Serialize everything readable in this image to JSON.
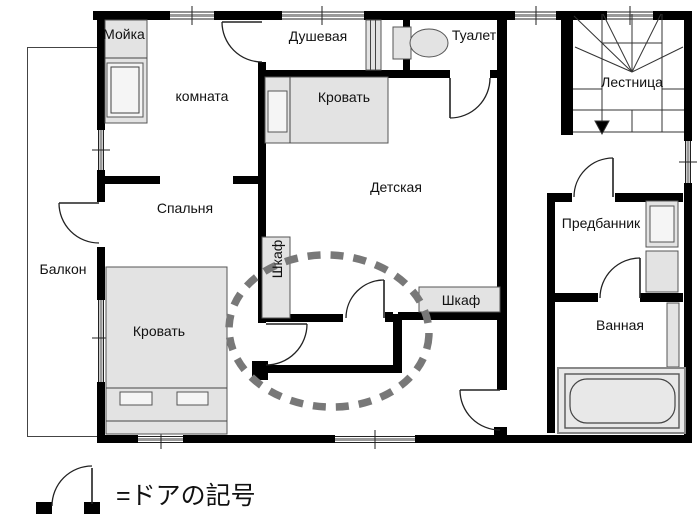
{
  "colors": {
    "wall": "#000000",
    "furniture": "#e3e3e3",
    "furniture-light": "#f5f5f5",
    "outline": "#444444",
    "highlight": "#787878",
    "text": "#111111",
    "bg": "#ffffff"
  },
  "rooms": {
    "balcony": "Балкон",
    "utility": "Мойка",
    "room": "комната",
    "shower": "Душевая",
    "toilet": "Туалет",
    "stairs": "Лестница",
    "nursery": "Детская",
    "bedroom": "Спальня",
    "anteroom": "Предбанник",
    "bathroom": "Ванная"
  },
  "furniture": {
    "bed_top": "Кровать",
    "bed_bottom": "Кровать",
    "wardrobe_left": "Шкаф",
    "wardrobe_right": "Шкаф"
  },
  "legend": {
    "label": "=ドアの記号"
  },
  "icons": {
    "door": "door-arc-symbol",
    "toilet": "toilet-top-view",
    "bathtub": "bathtub-top-view",
    "staircase": "staircase-with-down-arrow",
    "washing_machine": "washing-machine-top-view",
    "highlight": "dashed-ellipse-highlight"
  }
}
